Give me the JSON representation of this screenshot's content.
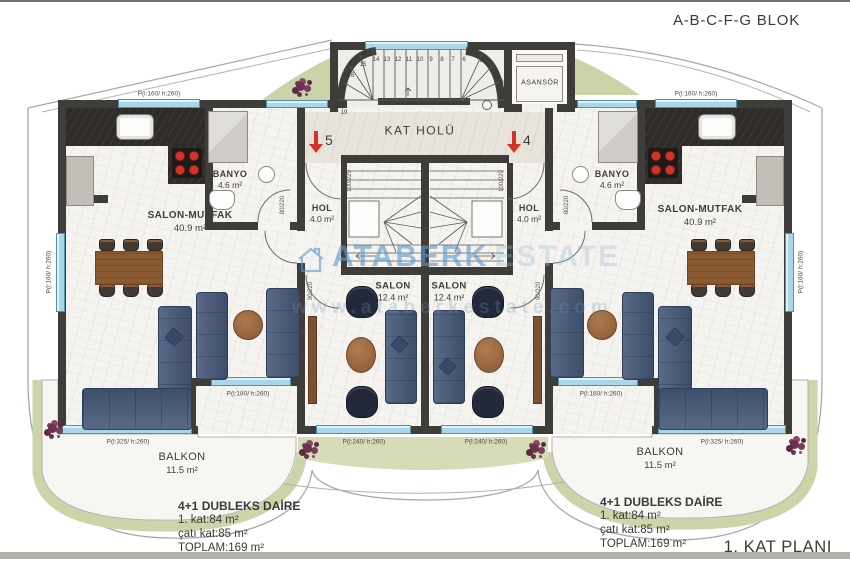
{
  "title": {
    "block": "A-B-C-F-G BLOK",
    "plan": "1. KAT PLANI"
  },
  "common": {
    "hall": "KAT HOLÜ",
    "elevator": "ASANSÖR"
  },
  "entrance": {
    "left_no": "5",
    "right_no": "4"
  },
  "rooms": {
    "salon_mutfak": {
      "name": "SALON-MUTFAK",
      "area": "40.9 m²"
    },
    "banyo": {
      "name": "BANYO",
      "area": "4.6 m²"
    },
    "hol": {
      "name": "HOL",
      "area": "4.0 m²"
    },
    "salon": {
      "name": "SALON",
      "area": "12.4 m²"
    },
    "balkon": {
      "name": "BALKON",
      "area": "11.5 m²"
    }
  },
  "summary": {
    "title": "4+1 DUBLEKS DAİRE",
    "line1": "1. kat:84 m²",
    "line2": "çatı kat:85 m²",
    "line3": "TOPLAM:169 m²"
  },
  "windows": {
    "w160": "P(l:160/ h:260)",
    "w180": "P(l:180/ h:260)",
    "w240": "P(l:240/ h:260)",
    "w325": "P(l:325/ h:260)"
  },
  "doors": {
    "entrance": "100/220",
    "salon": "90/220",
    "banyo": "80/220"
  },
  "stairs": {
    "numbers": [
      "1",
      "2",
      "3",
      "4",
      "5",
      "6",
      "7",
      "8",
      "9",
      "10",
      "11",
      "12",
      "13",
      "14",
      "15",
      "16",
      "17",
      "18",
      "19"
    ]
  },
  "watermark": {
    "brand": "ATABERK",
    "word": "ESTATE",
    "url": "www.ataberkestate.com"
  },
  "colors": {
    "wall": "#3f3d3a",
    "window": "#a9d6e8",
    "sofa": "#46597a",
    "accent_red": "#d93025",
    "green_band": "#cdd4aa",
    "wood": "#8a5a33",
    "watermark_blue": "#5b9bd0"
  }
}
